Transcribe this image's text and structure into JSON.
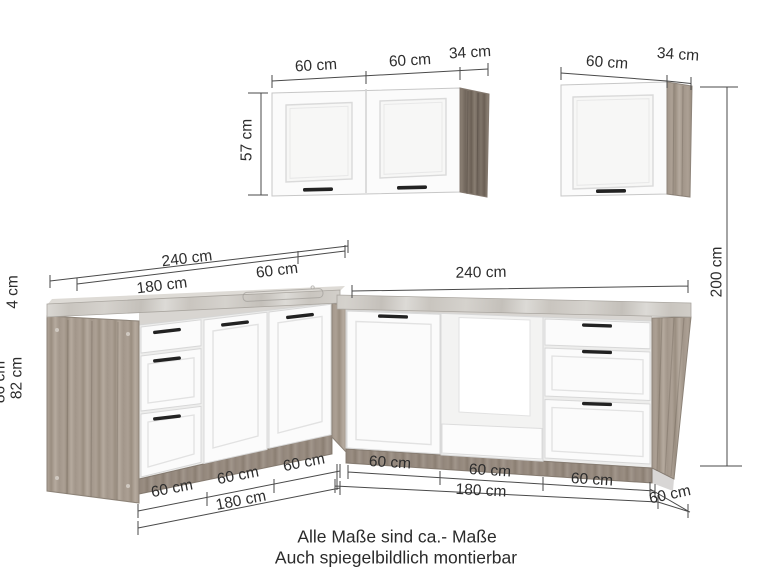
{
  "footer": {
    "line1": "Alle Maße sind ca.- Maße",
    "line2": "Auch spiegelbildlich montierbar"
  },
  "dims": {
    "wall_left_door1": "60 cm",
    "wall_left_door2": "60 cm",
    "wall_left_depth": "34 cm",
    "wall_left_height": "57 cm",
    "wall_right_door": "60 cm",
    "wall_right_depth": "34 cm",
    "total_height": "200 cm",
    "left_run_total": "240 cm",
    "left_run_front": "180 cm",
    "left_corner_unit": "60 cm",
    "right_run_total": "240 cm",
    "base_left_unit1": "60 cm",
    "base_left_unit2": "60 cm",
    "base_left_unit3": "60 cm",
    "base_left_front": "180 cm",
    "base_right_unit1": "60 cm",
    "base_right_unit2": "60 cm",
    "base_right_unit3": "60 cm",
    "base_right_front": "180 cm",
    "base_depth": "60 cm",
    "worktop_thickness": "4 cm",
    "carcass_height": "82 cm",
    "base_total_height": "86 cm"
  },
  "colors": {
    "wood_light": "#a59a8e",
    "wood_dark": "#776c62",
    "worktop_marble": "#cdc9c4",
    "door_white": "#fbfbfb",
    "handle": "#222222",
    "dim_line": "#4a4a4a"
  }
}
